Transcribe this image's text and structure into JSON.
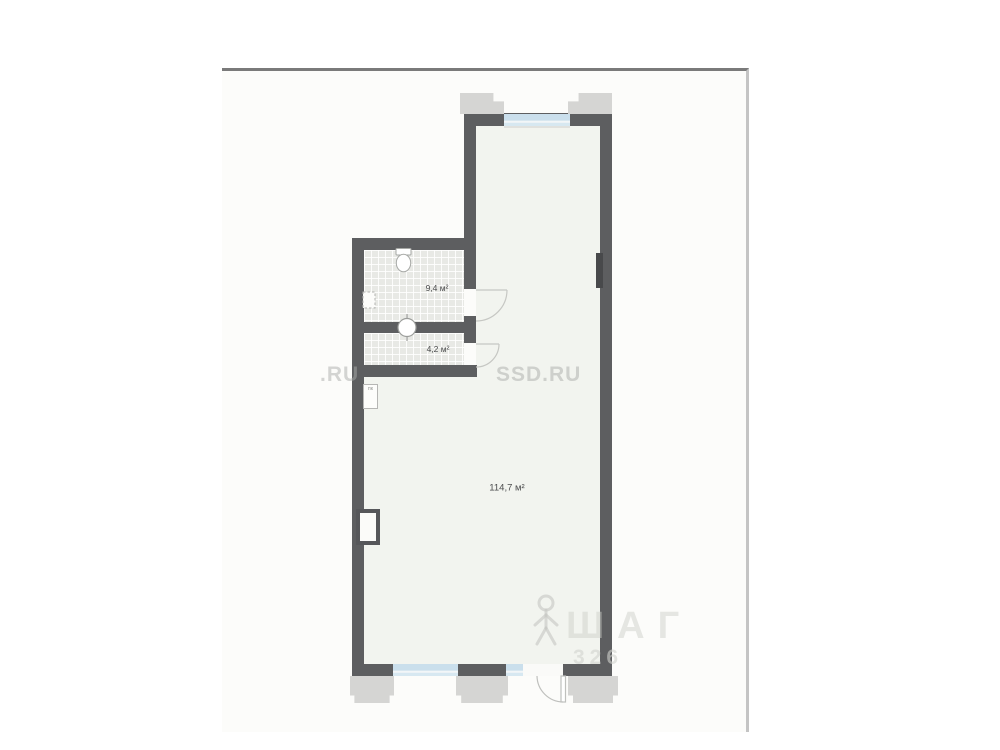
{
  "sheet": {
    "background": "#fcfcfa",
    "top_border_color": "#7a7a7a",
    "right_border_color": "#c4c4c4"
  },
  "plan": {
    "wall_color": "#5d5e60",
    "floor_color": "#f2f4ef",
    "tile_color": "#e8e9e5",
    "window_color": "#cadfec",
    "pier_color": "#d5d5d3",
    "rooms": [
      {
        "area_label": "9,4 м²"
      },
      {
        "area_label": "4,2 м²"
      },
      {
        "area_label": "114,7 м²"
      }
    ],
    "fixtures": [
      "toilet-icon",
      "plumbing-riser-icon"
    ],
    "utility_label": "пк"
  },
  "watermarks": {
    "left_fragment": ".RU",
    "center": "SSD.RU",
    "brand": "ШАГ",
    "brand_number": "326"
  }
}
